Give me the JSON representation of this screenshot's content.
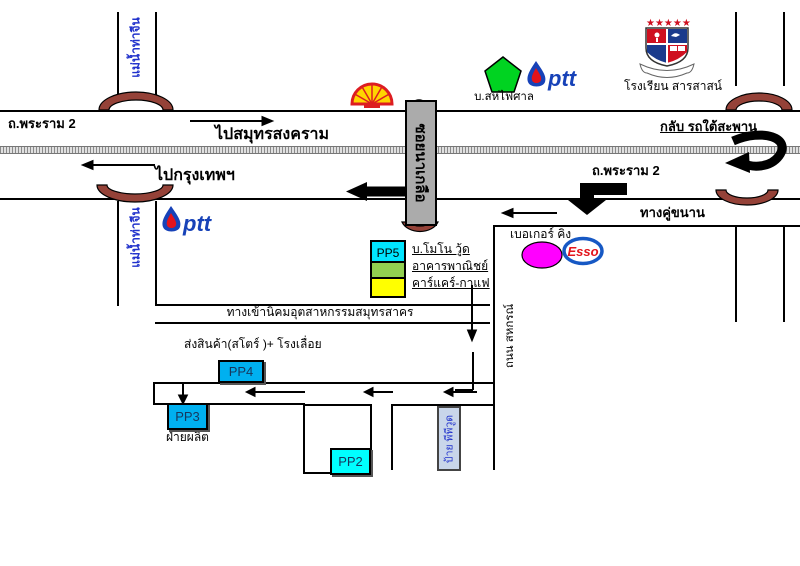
{
  "highway": {
    "rama2_left": "ถ.พระราม 2",
    "rama2_right": "ถ.พระราม 2",
    "to_samut_songkhram": "ไปสมุทรสงคราม",
    "to_bangkok": "ไปกรุงเทพฯ",
    "frontage_road": "ทางคู่ขนาน",
    "uturn_under_bridge": "กลับ รถใต้สะพาน"
  },
  "river": {
    "name": "แม่น้ำท่าจีน"
  },
  "side_road": {
    "name": "ถนน สหกรณ์"
  },
  "soi_sign": {
    "name": "ซอยนาเกลือ"
  },
  "landmarks": {
    "ptt_text": "ptt",
    "esso_text": "Esso",
    "pentagon_label": "บ.สหไฟศาล",
    "school_label": "โรงเรียน สารสาสน์",
    "school_stars": "★★★★★",
    "bakery_label": "เบอเกอร์ คิง"
  },
  "legend": {
    "pp5": "PP5",
    "items": [
      {
        "label": "บ.โมโน วู้ด",
        "color": "#00e5ff"
      },
      {
        "label": "อาคารพาณิชย์",
        "color": "#92d050"
      },
      {
        "label": "คาร์แคร์-กาแฟ",
        "color": "#ffff00"
      }
    ]
  },
  "site": {
    "industrial_entrance": "ทางเข้านิคมอุตสาหกรรมสมุทรสาคร",
    "store_sawmill": "ส่งสินค้า(สโตร์ )+ โรงเลื่อย",
    "production": "ฝ่ายผลิต",
    "pp4": "PP4",
    "pp3": "PP3",
    "pp2": "PP2",
    "ppwood_sign": "ป้าย พีพีวูด"
  },
  "colors": {
    "bridge": "#954238",
    "pp_blue": "#00b0f0",
    "pp_cyan": "#00ffff",
    "legend_green": "#92d050",
    "legend_yellow": "#ffff00",
    "sign_gray": "#ababab",
    "ppwood_box": "#c9d6ea",
    "river_text": "#2233cc",
    "magenta": "#ff00ff",
    "shell_yellow": "#ffd500",
    "shell_red": "#dd1d21",
    "ptt_blue": "#1742b8",
    "esso_red": "#e3131b",
    "pentagon_green": "#00d321"
  }
}
